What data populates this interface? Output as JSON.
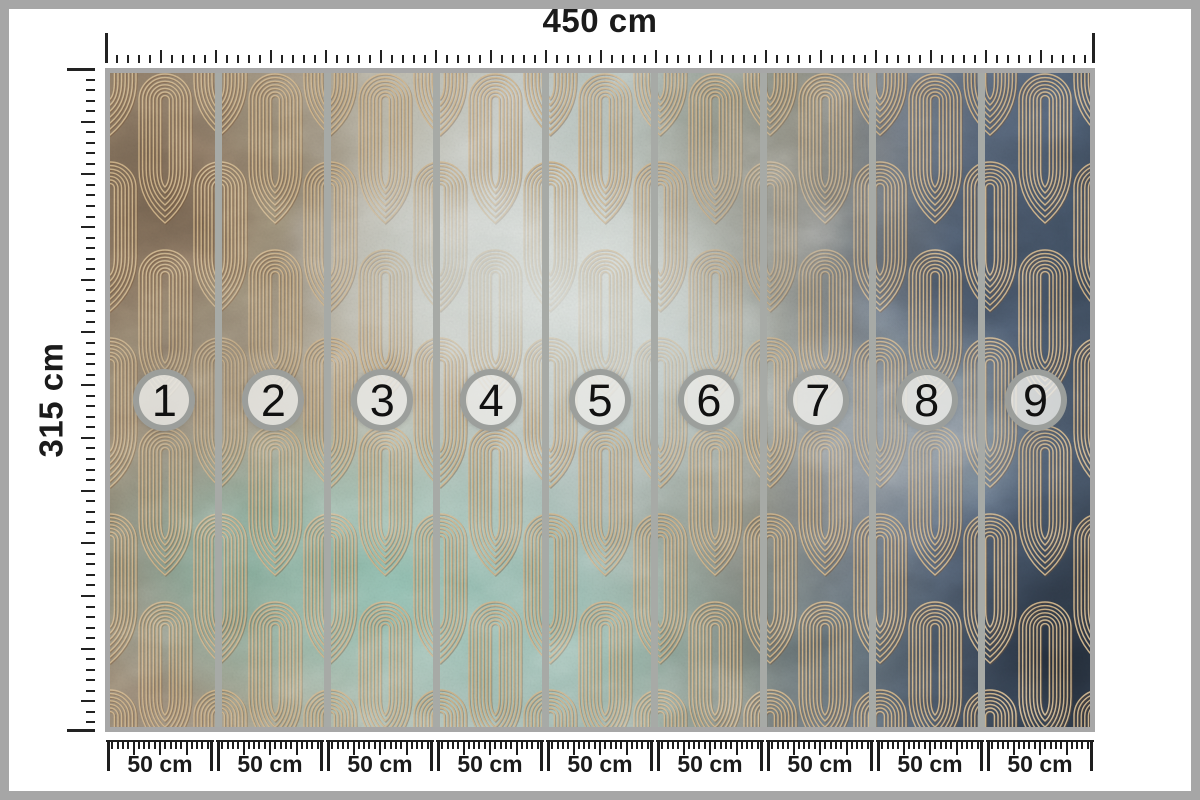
{
  "diagram": {
    "title": "wall mural panel dimension diagram",
    "total_width_label": "450 cm",
    "total_height_label": "315 cm",
    "segment_width_label": "50 cm",
    "panels": [
      {
        "number": "1"
      },
      {
        "number": "2"
      },
      {
        "number": "3"
      },
      {
        "number": "4"
      },
      {
        "number": "5"
      },
      {
        "number": "6"
      },
      {
        "number": "7"
      },
      {
        "number": "8"
      },
      {
        "number": "9"
      }
    ]
  },
  "palette": {
    "frame_gray": "#a6a6a6",
    "separator_gray": "#a7aaa6",
    "tick_black": "#1e1e1e",
    "text_black": "#1b1b1b",
    "badge_ring_gray": "#989b98",
    "badge_fill": "rgba(233,234,230,0.84)",
    "pattern_gold": "#cfb286",
    "pattern_shadow": "#6b4a2e",
    "mural_left_brown": "#8d7b67",
    "mural_center_silver": "#c3c9c4",
    "mural_teal": "#84b9ab",
    "mural_right_slate": "#42536a",
    "mural_dark_corner": "#2c3947"
  }
}
